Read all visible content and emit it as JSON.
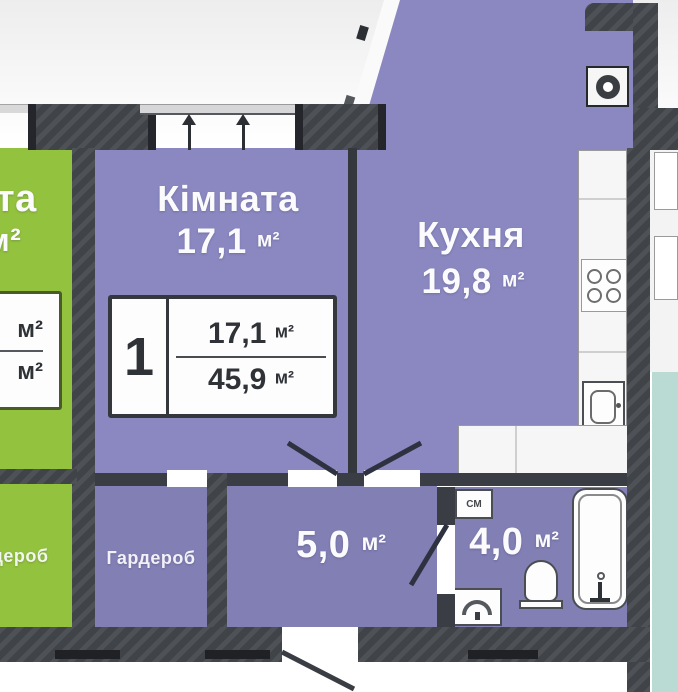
{
  "apartment": {
    "room": {
      "name": "Кімната",
      "area": "17,1",
      "unit": "м²"
    },
    "kitchen": {
      "name": "Кухня",
      "area": "19,8",
      "unit": "м²"
    },
    "hall": {
      "area": "5,0",
      "unit": "м²"
    },
    "bath": {
      "area": "4,0",
      "unit": "м²",
      "washer_tag": "СМ"
    },
    "wardrobe": {
      "name": "Гардероб"
    },
    "label_box": {
      "rooms": "1",
      "top_area": "17,1",
      "bottom_area": "45,9",
      "unit": "м²"
    }
  },
  "neighbor": {
    "room_name_fragment": "та",
    "room_unit_fragment": "м²",
    "wardrobe": "Гардероб",
    "label_box": {
      "top_unit": "м²",
      "bottom_unit": "м²"
    }
  },
  "colors": {
    "room_purple": "#8b88c1",
    "service_purple": "#827fb5",
    "neighbor_green": "#93c23f",
    "wall_dark": "#43474c",
    "adjacent_teal": "#b9dbd3",
    "fixture_white": "#fdfdfd"
  }
}
